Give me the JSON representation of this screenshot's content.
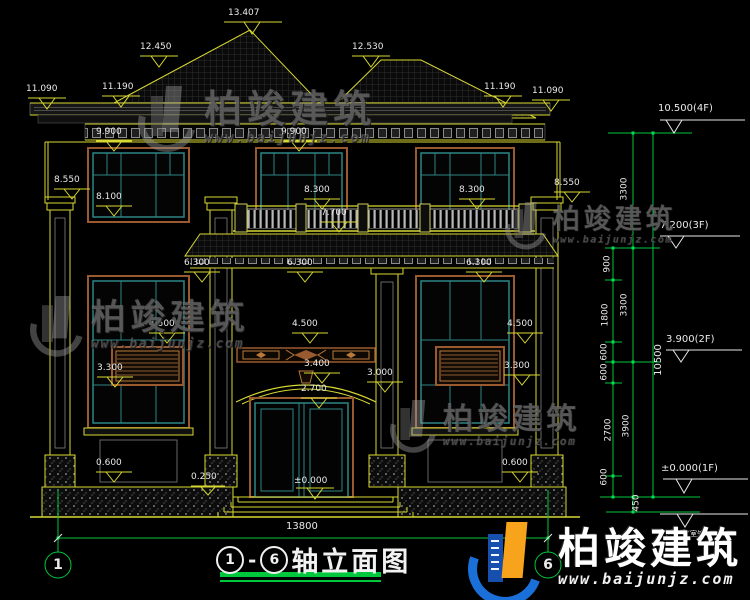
{
  "drawing": {
    "title": {
      "axis_start": "1",
      "axis_separator": "-",
      "axis_end": "6",
      "name": "轴立面图"
    },
    "axes": {
      "left": "1",
      "right": "6"
    },
    "elevations": {
      "roof_peak": "13.407",
      "roof_left": "12.450",
      "roof_right": "12.530",
      "eave_far_left": "11.090",
      "eave_left": "11.190",
      "eave_right": "11.190",
      "eave_far_right": "11.090",
      "cornice_left": "9.900",
      "cornice_mid": "9.900",
      "cap_left": "8.550",
      "sill_2f_left": "8.100",
      "rail_left": "8.300",
      "rail_right": "8.300",
      "cap_right": "8.550",
      "balcony": "7.700",
      "canopy_left": "6.300",
      "canopy_mid": "6.300",
      "canopy_right": "6.300",
      "win_top_left": "4.500",
      "win_top_mid": "4.500",
      "win_top_right": "4.500",
      "sill_left": "3.300",
      "arch": "3.400",
      "porch": "3.000",
      "sill_right": "3.300",
      "door": "2.700",
      "plinth_left": "0.600",
      "plinth_right": "0.600",
      "step": "0.250",
      "ground": "±0.000"
    },
    "levels": {
      "f4": "10.500(4F)",
      "f3": "7.200(3F)",
      "f2": "3.900(2F)",
      "f1": "±0.000(1F)",
      "outdoor": "-0.450",
      "outdoor_note": "(室外地面)"
    },
    "dims": {
      "story_top": "3300",
      "story_mid": "3300",
      "story_bottom": "3900",
      "seg_900": "900",
      "seg_1800": "1800",
      "seg_600_a": "600",
      "seg_600_b": "600",
      "seg_600_c": "600",
      "seg_2700": "2700",
      "seg_600_d": "600",
      "seg_450": "450",
      "total_height": "10500",
      "total_width": "13800"
    },
    "colors": {
      "cad_yellow": "#d8d832",
      "cad_green": "#00c83c",
      "window_teal": "#2e8585",
      "trim_brown": "#9a5a30",
      "brand_blue": "#1a70d8",
      "brand_orange": "#f7a31c"
    }
  },
  "watermark": {
    "name": "柏竣建筑",
    "url": "www.baijunjz.com"
  },
  "brand": {
    "name": "柏竣建筑",
    "url": "www.baijunjz.com"
  }
}
